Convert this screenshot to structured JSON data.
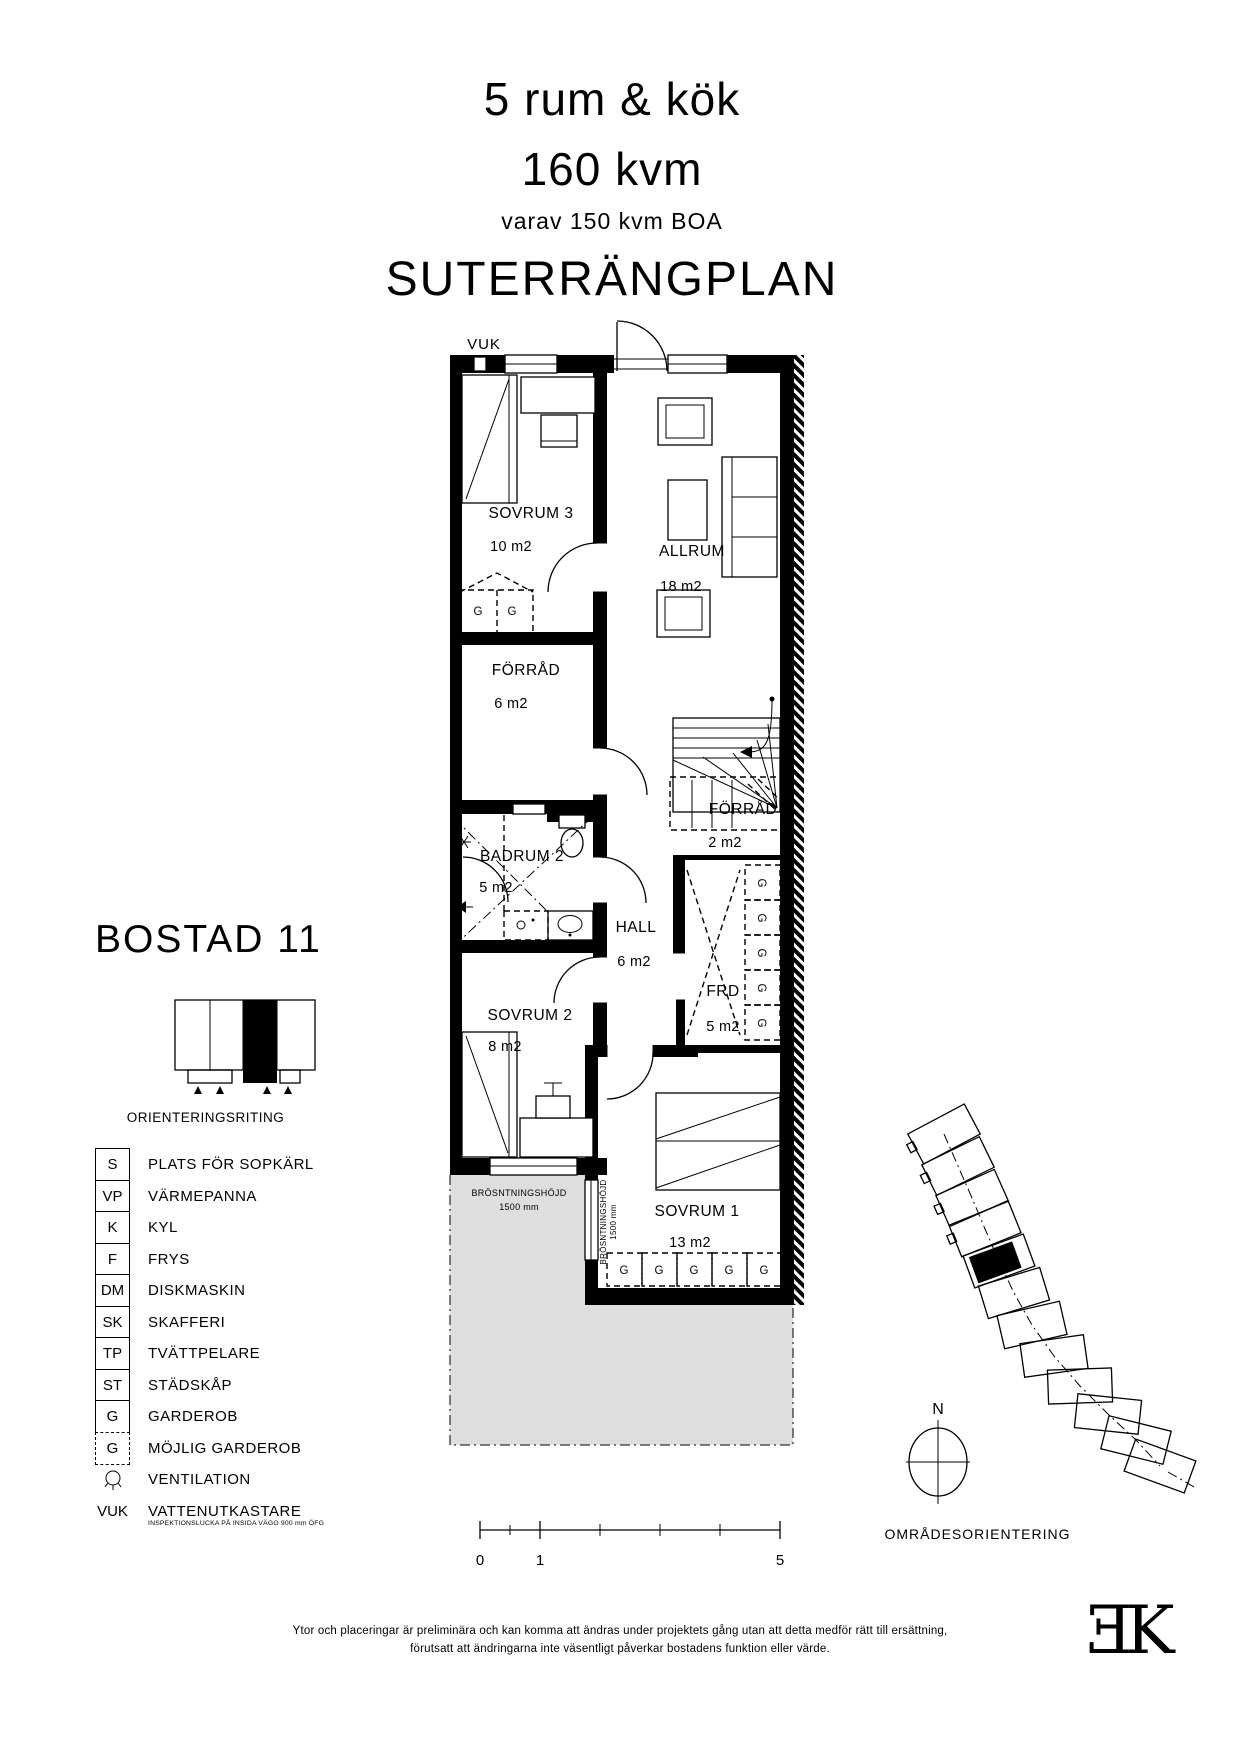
{
  "header": {
    "rooms_line": "5 rum & kök",
    "area_line": "160 kvm",
    "boa_line": "varav 150 kvm BOA",
    "plan_line": "SUTERRÄNGPLAN"
  },
  "unit_label": "BOSTAD 11",
  "orientation_caption": "ORIENTERINGSRITING",
  "legend": [
    {
      "sym": "S",
      "label": "PLATS FÖR SOPKÄRL",
      "box": "solid"
    },
    {
      "sym": "VP",
      "label": "VÄRMEPANNA",
      "box": "solid"
    },
    {
      "sym": "K",
      "label": "KYL",
      "box": "solid"
    },
    {
      "sym": "F",
      "label": "FRYS",
      "box": "solid"
    },
    {
      "sym": "DM",
      "label": "DISKMASKIN",
      "box": "solid"
    },
    {
      "sym": "SK",
      "label": "SKAFFERI",
      "box": "solid"
    },
    {
      "sym": "TP",
      "label": "TVÄTTPELARE",
      "box": "solid"
    },
    {
      "sym": "ST",
      "label": "STÄDSKÅP",
      "box": "solid"
    },
    {
      "sym": "G",
      "label": "GARDEROB",
      "box": "solid"
    },
    {
      "sym": "G",
      "label": "MÖJLIG GARDEROB",
      "box": "dashed"
    },
    {
      "sym": "",
      "label": "VENTILATION",
      "box": "vent"
    },
    {
      "sym": "VUK",
      "label": "VATTENUTKASTARE",
      "box": "none",
      "note": "INSPEKTIONSLUCKA PÅ INSIDA VÄGG 900 mm ÖFG"
    }
  ],
  "plan": {
    "vuk": "VUK",
    "rooms": {
      "sovrum3": {
        "name": "SOVRUM 3",
        "area": "10 m2"
      },
      "allrum": {
        "name": "ALLRUM",
        "area": "18 m2"
      },
      "forrad6": {
        "name": "FÖRRÅD",
        "area": "6 m2"
      },
      "forrad2": {
        "name": "FÖRRÅD",
        "area": "2 m2"
      },
      "badrum2": {
        "name": "BADRUM 2",
        "area": "5 m2"
      },
      "hall": {
        "name": "HALL",
        "area": "6 m2"
      },
      "frd": {
        "name": "FRD",
        "area": "5 m2"
      },
      "sovrum2": {
        "name": "SOVRUM 2",
        "area": "8 m2"
      },
      "sovrum1": {
        "name": "SOVRUM 1",
        "area": "13 m2"
      }
    },
    "wardrobe": "G",
    "sill_note": {
      "label": "BRÖSNTNINGSHÖJD",
      "value": "1500 mm"
    }
  },
  "site": {
    "north": "N",
    "caption": "OMRÅDESORIENTERING"
  },
  "scalebar": {
    "zero": "0",
    "one": "1",
    "five": "5"
  },
  "disclaimer": {
    "line1": "Ytor och placeringar är preliminära och kan komma att ändras under projektets gång utan att detta medför rätt till ersättning,",
    "line2": "förutsatt att ändringarna inte väsentligt påverkar bostadens funktion eller värde."
  },
  "logo": {
    "e": "Ǝ",
    "k": "K"
  },
  "colors": {
    "ink": "#000000",
    "terrace": "#dedede"
  }
}
